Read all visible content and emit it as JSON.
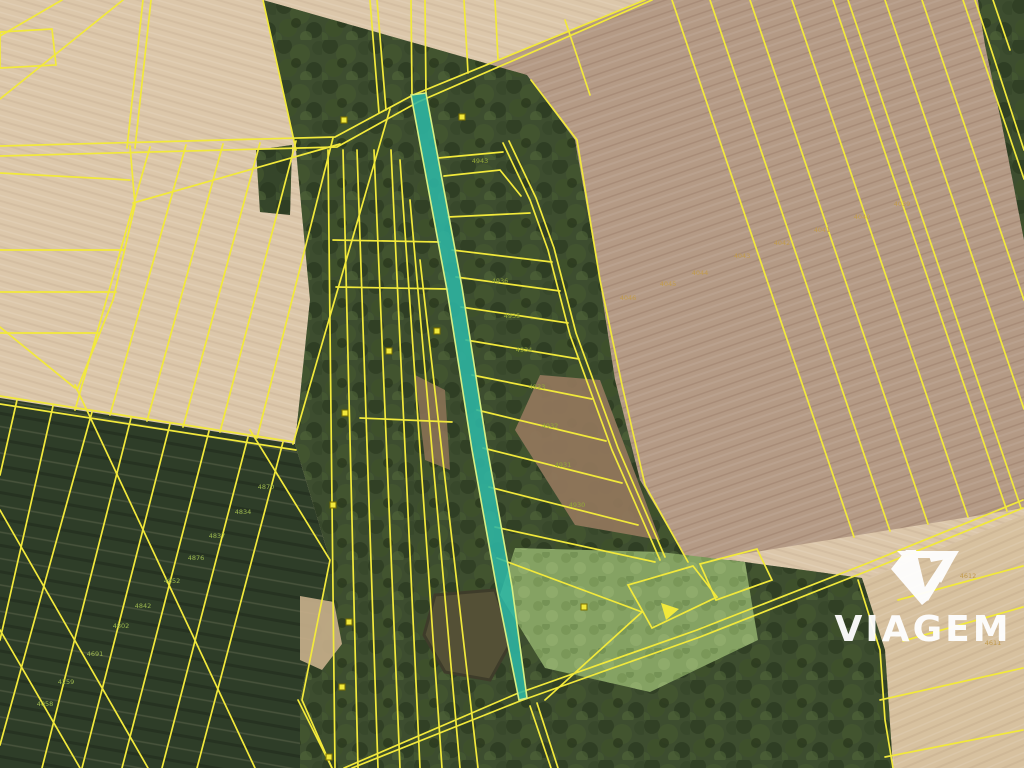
{
  "branding": {
    "logo_text": "VIAGEM",
    "logo_color": "#ffffff",
    "logo_mark": "viagem-v-icon"
  },
  "map": {
    "type": "cadastral-aerial-orthophoto",
    "parcel_line_color": "#f2e93b",
    "highlighted_parcel": {
      "fill": "#2eb6a4",
      "border": "#d6ef84",
      "description": "long narrow highlighted parcel strip"
    },
    "terrain_colors": {
      "field_light": "#dcc7aa",
      "field_brown": "#b49a85",
      "field_bottom_right": "#d7c19f",
      "dark_crop_field": "#2e3d28",
      "forest": "#3d4d2f",
      "clearing": "#85a263",
      "pond": "#545036"
    },
    "parcel_labels": [
      {
        "text": "4870",
        "x": 266,
        "y": 489,
        "color": "#9db84f"
      },
      {
        "text": "4834",
        "x": 243,
        "y": 514,
        "color": "#9db84f"
      },
      {
        "text": "4837",
        "x": 217,
        "y": 538,
        "color": "#9db84f"
      },
      {
        "text": "4876",
        "x": 196,
        "y": 560,
        "color": "#9db84f"
      },
      {
        "text": "4852",
        "x": 172,
        "y": 583,
        "color": "#9db84f"
      },
      {
        "text": "4842",
        "x": 143,
        "y": 608,
        "color": "#9db84f"
      },
      {
        "text": "4802",
        "x": 121,
        "y": 628,
        "color": "#9db84f"
      },
      {
        "text": "4691",
        "x": 95,
        "y": 656,
        "color": "#9db84f"
      },
      {
        "text": "4259",
        "x": 66,
        "y": 684,
        "color": "#9db84f"
      },
      {
        "text": "4058",
        "x": 45,
        "y": 706,
        "color": "#9db84f"
      },
      {
        "text": "4046",
        "x": 628,
        "y": 300,
        "color": "#c19a4b"
      },
      {
        "text": "4045",
        "x": 668,
        "y": 286,
        "color": "#c19a4b"
      },
      {
        "text": "4044",
        "x": 700,
        "y": 275,
        "color": "#c19a4b"
      },
      {
        "text": "4043",
        "x": 742,
        "y": 258,
        "color": "#c19a4b"
      },
      {
        "text": "4042",
        "x": 782,
        "y": 245,
        "color": "#c19a4b"
      },
      {
        "text": "4041",
        "x": 822,
        "y": 232,
        "color": "#c19a4b"
      },
      {
        "text": "4040",
        "x": 862,
        "y": 219,
        "color": "#c19a4b"
      },
      {
        "text": "4039",
        "x": 902,
        "y": 206,
        "color": "#c19a4b"
      },
      {
        "text": "4943",
        "x": 480,
        "y": 163,
        "color": "#93a839"
      },
      {
        "text": "4936",
        "x": 500,
        "y": 283,
        "color": "#93a839"
      },
      {
        "text": "4935",
        "x": 512,
        "y": 318,
        "color": "#93a839"
      },
      {
        "text": "4934",
        "x": 524,
        "y": 352,
        "color": "#93a839"
      },
      {
        "text": "4933",
        "x": 537,
        "y": 389,
        "color": "#93a839"
      },
      {
        "text": "4932",
        "x": 550,
        "y": 428,
        "color": "#93a839"
      },
      {
        "text": "4931",
        "x": 563,
        "y": 467,
        "color": "#93a839"
      },
      {
        "text": "4930",
        "x": 577,
        "y": 507,
        "color": "#93a839"
      },
      {
        "text": "4612",
        "x": 968,
        "y": 578,
        "color": "#c19a4b"
      },
      {
        "text": "4611",
        "x": 993,
        "y": 645,
        "color": "#c19a4b"
      }
    ],
    "building_markers": [
      {
        "x": 344,
        "y": 120
      },
      {
        "x": 462,
        "y": 117
      },
      {
        "x": 389,
        "y": 351
      },
      {
        "x": 437,
        "y": 331
      },
      {
        "x": 345,
        "y": 413
      },
      {
        "x": 333,
        "y": 505
      },
      {
        "x": 349,
        "y": 622
      },
      {
        "x": 342,
        "y": 687
      },
      {
        "x": 329,
        "y": 757
      },
      {
        "x": 584,
        "y": 607
      }
    ],
    "arrow_marker": {
      "points": "661,603 679,609 666,620"
    }
  }
}
